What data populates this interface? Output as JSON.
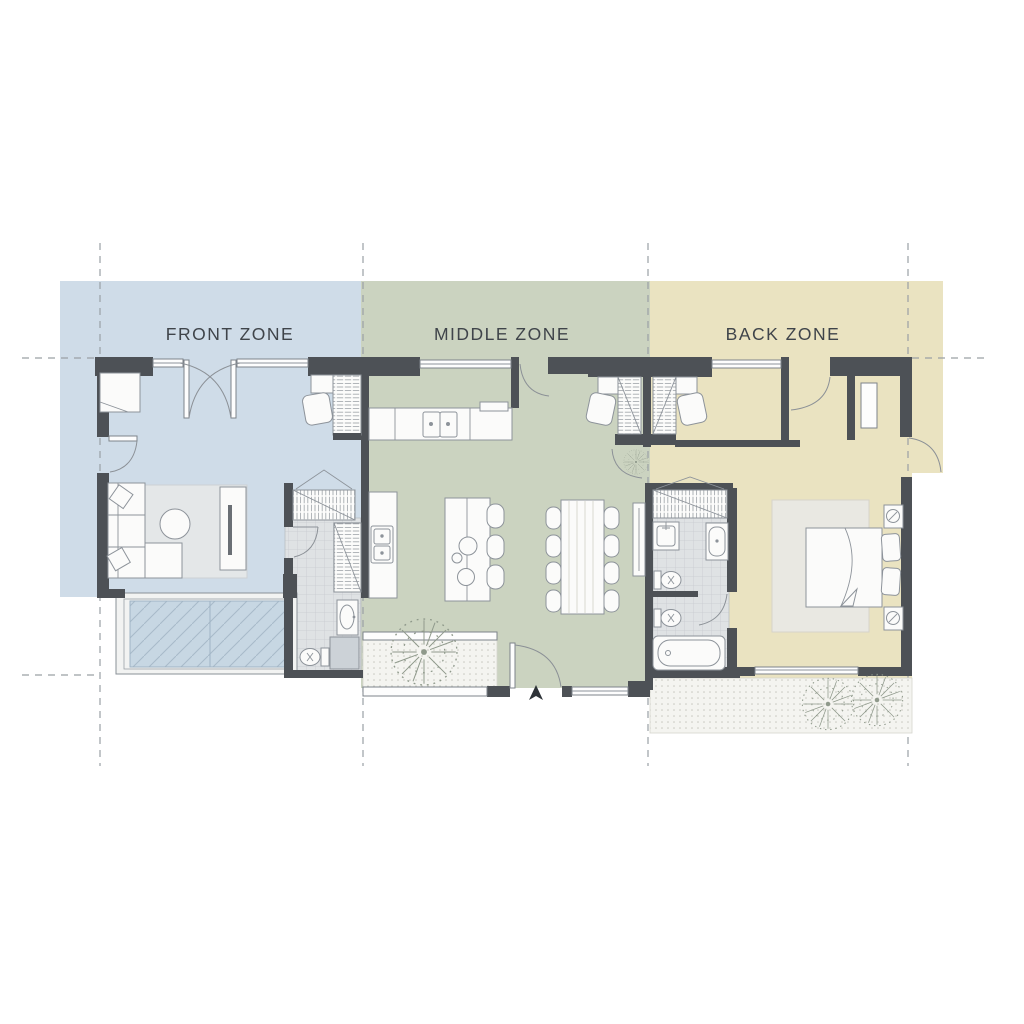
{
  "zones": [
    {
      "id": "front",
      "label": "FRONT ZONE",
      "color": "#cfdce8"
    },
    {
      "id": "middle",
      "label": "MIDDLE ZONE",
      "color": "#cbd3c0"
    },
    {
      "id": "back",
      "label": "BACK ZONE",
      "color": "#eae3c1"
    }
  ],
  "palette": {
    "background": "#ffffff",
    "wall": "#4d5156",
    "gridline": "#9aa0a5",
    "furniture_outline": "#8d939a",
    "glass": "#c7d7e3",
    "tile_floor": "#dfe2e4",
    "paving": "#f4f4f0",
    "living_rug": "#e4e7e8",
    "bedroom_rug": "#e9e8e2",
    "tree": "#8f998b",
    "label_text": "#3f444a"
  }
}
